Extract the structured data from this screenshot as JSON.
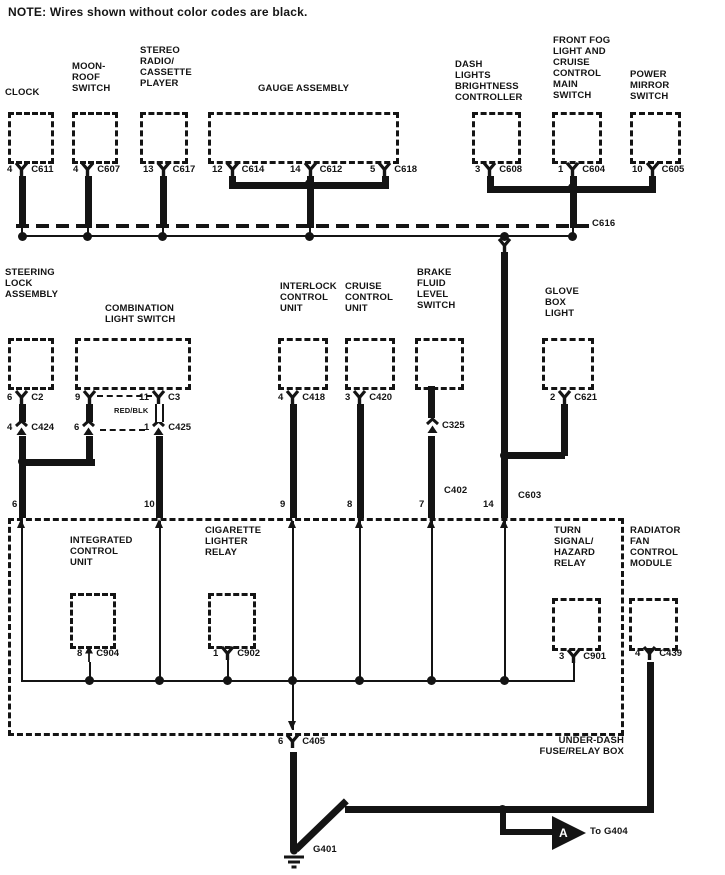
{
  "note": "NOTE: Wires shown without color codes are black.",
  "top": {
    "clock": {
      "label": "CLOCK",
      "pin": "4",
      "conn": "C611"
    },
    "moonroof": {
      "label": "MOON-\nROOF\nSWITCH",
      "pin": "4",
      "conn": "C607"
    },
    "stereo": {
      "label": "STEREO\nRADIO/\nCASSETTE\nPLAYER",
      "pin": "13",
      "conn": "C617"
    },
    "gauge": {
      "label": "GAUGE ASSEMBLY",
      "pin1": "12",
      "conn1": "C614",
      "pin2": "14",
      "conn2": "C612",
      "pin3": "5",
      "conn3": "C618"
    },
    "dash": {
      "label": "DASH\nLIGHTS\nBRIGHTNESS\nCONTROLLER",
      "pin": "3",
      "conn": "C608"
    },
    "fog": {
      "label": "FRONT FOG\nLIGHT AND\nCRUISE\nCONTROL\nMAIN\nSWITCH",
      "pin": "1",
      "conn": "C604"
    },
    "mirror": {
      "label": "POWER\nMIRROR\nSWITCH",
      "pin": "10",
      "conn": "C605"
    }
  },
  "bus": {
    "conn": "C616"
  },
  "mid": {
    "steering": {
      "label": "STEERING\nLOCK\nASSEMBLY",
      "pin": "6",
      "conn": "C2",
      "pin2": "4",
      "conn2": "C424"
    },
    "comb": {
      "label": "COMBINATION\nLIGHT SWITCH",
      "pinL": "9",
      "pinR": "11",
      "conn": "C3",
      "wire_color": "RED/BLK",
      "subL": "6",
      "subR": "1",
      "subConn": "C425"
    },
    "interlock": {
      "label": "INTERLOCK\nCONTROL\nUNIT",
      "pin": "4",
      "conn": "C418"
    },
    "cruise": {
      "label": "CRUISE\nCONTROL\nUNIT",
      "pin": "3",
      "conn": "C420"
    },
    "brake": {
      "label": "BRAKE\nFLUID\nLEVEL\nSWITCH",
      "conn1": "C325",
      "conn2": "C402"
    },
    "glove": {
      "label": "GLOVE\nBOX\nLIGHT",
      "pin": "2",
      "conn": "C621"
    },
    "main_conn": "C603"
  },
  "fusebox": {
    "label": "UNDER-DASH\nFUSE/RELAY BOX",
    "pins": {
      "steering": "6",
      "comb": "10",
      "interlock": "9",
      "cruise": "8",
      "brake": "7",
      "main": "14"
    },
    "icu": {
      "label": "INTEGRATED\nCONTROL\nUNIT",
      "pin": "8",
      "conn": "C904"
    },
    "cig": {
      "label": "CIGARETTE\nLIGHTER\nRELAY",
      "pin": "1",
      "conn": "C902"
    },
    "turn": {
      "label": "TURN\nSIGNAL/\nHAZARD\nRELAY",
      "pin": "3",
      "conn": "C901"
    },
    "exit": {
      "pin": "6",
      "conn": "C405"
    }
  },
  "radiator": {
    "label": "RADIATOR\nFAN\nCONTROL\nMODULE",
    "pin": "4",
    "conn": "C439"
  },
  "ground": {
    "g401": "G401",
    "arrow_letter": "A",
    "to_g404": "To G404"
  },
  "colors": {
    "ink": "#141414",
    "paper": "#ffffff"
  }
}
